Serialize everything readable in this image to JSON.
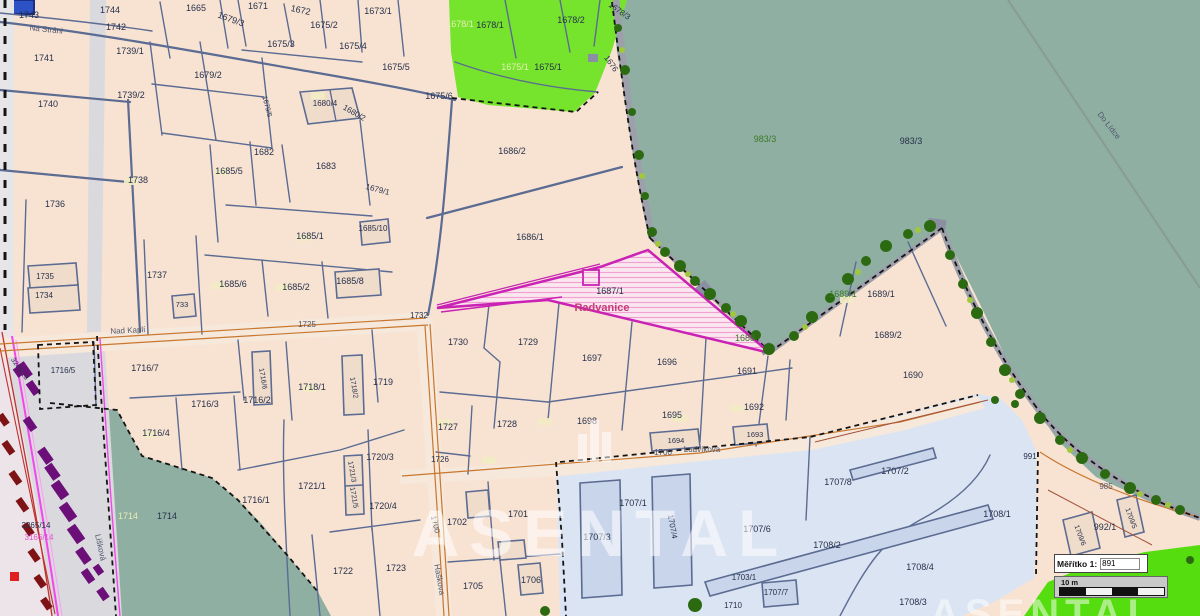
{
  "app": {
    "type": "cadastral-map-viewer"
  },
  "scale_widget": {
    "label": "Měřítko 1:",
    "value": "891",
    "bar_label": "10 m"
  },
  "watermark": {
    "text": "ASENTAL",
    "partial_text": "ASENTAL"
  },
  "colors": {
    "parcel_fill": "#f8e3d3",
    "forest_teal": "#8fafa2",
    "green_parcel": "#76e42d",
    "lawn": "#56dd10",
    "industrial_blue": "#dbe4f2",
    "water_blue": "#2d52c6",
    "boundary": "#5b6b92",
    "highlight_magenta": "#c922b4",
    "road_orange": "#c8772f",
    "area_name_red": "#c63a7a",
    "tree_green": "#2c6a12",
    "building_purple": "#6d0f78"
  },
  "map": {
    "area_label": "Radvanice",
    "highlighted_parcel_number": "1687/1",
    "streets": [
      "Na Stráni",
      "Nad Kaplí",
      "Ludvíkova",
      "Haškova",
      "Lišková",
      "Do Lídce"
    ],
    "road_numbers": [
      "1725",
      "1700",
      "1676",
      "985"
    ],
    "labels": [
      {
        "t": "1743",
        "x": 29,
        "y": 18
      },
      {
        "t": "1744",
        "x": 110,
        "y": 13
      },
      {
        "t": "1742",
        "x": 116,
        "y": 30
      },
      {
        "t": "1665",
        "x": 196,
        "y": 11
      },
      {
        "t": "1671",
        "x": 258,
        "y": 9
      },
      {
        "t": "1672",
        "x": 300,
        "y": 13,
        "r": 12
      },
      {
        "t": "1673/1",
        "x": 378,
        "y": 14
      },
      {
        "t": "1675/2",
        "x": 324,
        "y": 28
      },
      {
        "t": "1679/3",
        "x": 230,
        "y": 22,
        "r": 20
      },
      {
        "t": "1675/3",
        "x": 281,
        "y": 47
      },
      {
        "t": "1675/4",
        "x": 353,
        "y": 49
      },
      {
        "t": "1675/5",
        "x": 396,
        "y": 70
      },
      {
        "t": "1675/6",
        "x": 439,
        "y": 99
      },
      {
        "t": "1679/2",
        "x": 208,
        "y": 78
      },
      {
        "t": "1739/1",
        "x": 130,
        "y": 54
      },
      {
        "t": "1741",
        "x": 44,
        "y": 61
      },
      {
        "t": "1739/2",
        "x": 131,
        "y": 98
      },
      {
        "t": "1740",
        "x": 48,
        "y": 107
      },
      {
        "t": "1679/6",
        "x": 265,
        "y": 107,
        "r": 75,
        "s": 7
      },
      {
        "t": "1680/4",
        "x": 325,
        "y": 106,
        "s": 8
      },
      {
        "t": "1680/2",
        "x": 353,
        "y": 115,
        "r": 30,
        "s": 8
      },
      {
        "t": "1682",
        "x": 264,
        "y": 155
      },
      {
        "t": "1683",
        "x": 326,
        "y": 169
      },
      {
        "t": "1685/5",
        "x": 229,
        "y": 174
      },
      {
        "t": "1738",
        "x": 138,
        "y": 183
      },
      {
        "t": "1679/1",
        "x": 377,
        "y": 192,
        "r": 15,
        "s": 8
      },
      {
        "t": "1736",
        "x": 55,
        "y": 207
      },
      {
        "t": "1685/10",
        "x": 373,
        "y": 231,
        "s": 8
      },
      {
        "t": "1685/1",
        "x": 310,
        "y": 239
      },
      {
        "t": "1737",
        "x": 157,
        "y": 278
      },
      {
        "t": "1735",
        "x": 45,
        "y": 279,
        "s": 8
      },
      {
        "t": "1685/6",
        "x": 233,
        "y": 287
      },
      {
        "t": "1685/2",
        "x": 296,
        "y": 290
      },
      {
        "t": "1685/8",
        "x": 350,
        "y": 284
      },
      {
        "t": "1734",
        "x": 44,
        "y": 298,
        "s": 8
      },
      {
        "t": "733",
        "x": 182,
        "y": 307,
        "s": 7.5
      },
      {
        "t": "1686/2",
        "x": 512,
        "y": 154
      },
      {
        "t": "1686/1",
        "x": 530,
        "y": 240
      },
      {
        "t": "1678/1",
        "x": 460,
        "y": 27,
        "c": "y"
      },
      {
        "t": "1678/1",
        "x": 490,
        "y": 28
      },
      {
        "t": "1678/2",
        "x": 571,
        "y": 23
      },
      {
        "t": "1678/3",
        "x": 618,
        "y": 13,
        "r": 35,
        "s": 8
      },
      {
        "t": "1675/1",
        "x": 515,
        "y": 70,
        "c": "y"
      },
      {
        "t": "1675/1",
        "x": 548,
        "y": 70
      },
      {
        "t": "1676",
        "x": 609,
        "y": 65,
        "r": 55,
        "s": 8
      },
      {
        "t": "983/3",
        "x": 765,
        "y": 142,
        "c": "g"
      },
      {
        "t": "983/3",
        "x": 911,
        "y": 144
      },
      {
        "t": "Do Lídce",
        "x": 1107,
        "y": 127,
        "r": 52,
        "c": "s"
      },
      {
        "t": "1687/1",
        "x": 610,
        "y": 294
      },
      {
        "t": "Radvanice",
        "x": 602,
        "y": 311,
        "c": "m"
      },
      {
        "t": "1688",
        "x": 745,
        "y": 341,
        "c": "g"
      },
      {
        "t": "1689/1",
        "x": 843,
        "y": 297,
        "c": "g"
      },
      {
        "t": "1689/1",
        "x": 881,
        "y": 297
      },
      {
        "t": "1689/2",
        "x": 888,
        "y": 338
      },
      {
        "t": "1690",
        "x": 913,
        "y": 378
      },
      {
        "t": "1691",
        "x": 747,
        "y": 374
      },
      {
        "t": "1732",
        "x": 419,
        "y": 318,
        "s": 8
      },
      {
        "t": "1730",
        "x": 458,
        "y": 345
      },
      {
        "t": "1729",
        "x": 528,
        "y": 345
      },
      {
        "t": "1697",
        "x": 592,
        "y": 361
      },
      {
        "t": "1696",
        "x": 667,
        "y": 365
      },
      {
        "t": "Nad Kaplí",
        "x": 128,
        "y": 333,
        "r": -3,
        "c": "s"
      },
      {
        "t": "1725",
        "x": 307,
        "y": 327,
        "c": "s"
      },
      {
        "t": "1716/5",
        "x": 63,
        "y": 373,
        "s": 8
      },
      {
        "t": "1716/7",
        "x": 145,
        "y": 371
      },
      {
        "t": "1716/6",
        "x": 261,
        "y": 379,
        "r": 80,
        "s": 7
      },
      {
        "t": "1718/1",
        "x": 312,
        "y": 390
      },
      {
        "t": "1718/2",
        "x": 352,
        "y": 388,
        "r": 80,
        "s": 7
      },
      {
        "t": "1719",
        "x": 383,
        "y": 385
      },
      {
        "t": "1716/3",
        "x": 205,
        "y": 407
      },
      {
        "t": "1716/2",
        "x": 257,
        "y": 403
      },
      {
        "t": "1716/4",
        "x": 156,
        "y": 436
      },
      {
        "t": "1716/1",
        "x": 256,
        "y": 503
      },
      {
        "t": "1721/1",
        "x": 312,
        "y": 489
      },
      {
        "t": "1720/3",
        "x": 380,
        "y": 460
      },
      {
        "t": "1721/3",
        "x": 350,
        "y": 472,
        "r": 80,
        "s": 7
      },
      {
        "t": "1721/5",
        "x": 352,
        "y": 498,
        "r": 80,
        "s": 7
      },
      {
        "t": "1720/4",
        "x": 383,
        "y": 509
      },
      {
        "t": "1714",
        "x": 128,
        "y": 519,
        "c": "y"
      },
      {
        "t": "1714",
        "x": 167,
        "y": 519
      },
      {
        "t": "3265/14",
        "x": 36,
        "y": 528,
        "s": 8
      },
      {
        "t": "3166/14",
        "x": 39,
        "y": 540,
        "c": "mg",
        "s": 8
      },
      {
        "t": "3265/13",
        "x": 18,
        "y": 370,
        "r": 55,
        "s": 7
      },
      {
        "t": "Lišková",
        "x": 98,
        "y": 548,
        "r": 78,
        "c": "s"
      },
      {
        "t": "1722",
        "x": 343,
        "y": 574
      },
      {
        "t": "1723",
        "x": 396,
        "y": 571
      },
      {
        "t": "1727",
        "x": 448,
        "y": 430
      },
      {
        "t": "1728",
        "x": 507,
        "y": 427
      },
      {
        "t": "1726",
        "x": 440,
        "y": 462,
        "s": 8
      },
      {
        "t": "1698",
        "x": 587,
        "y": 424
      },
      {
        "t": "1695",
        "x": 672,
        "y": 418
      },
      {
        "t": "1692",
        "x": 754,
        "y": 410
      },
      {
        "t": "1694",
        "x": 676,
        "y": 443,
        "s": 7.5
      },
      {
        "t": "1693",
        "x": 755,
        "y": 437,
        "s": 7.5
      },
      {
        "t": "1700",
        "x": 663,
        "y": 455,
        "c": "s"
      },
      {
        "t": "Ludvíkova",
        "x": 702,
        "y": 452,
        "c": "s"
      },
      {
        "t": "1700",
        "x": 433,
        "y": 525,
        "r": 75,
        "c": "s"
      },
      {
        "t": "Haškova",
        "x": 437,
        "y": 580,
        "r": 80,
        "c": "s"
      },
      {
        "t": "1701",
        "x": 518,
        "y": 517
      },
      {
        "t": "1702",
        "x": 457,
        "y": 525
      },
      {
        "t": "1705",
        "x": 473,
        "y": 589
      },
      {
        "t": "1706",
        "x": 531,
        "y": 583
      },
      {
        "t": "1707/1",
        "x": 633,
        "y": 506
      },
      {
        "t": "1707/3",
        "x": 597,
        "y": 540
      },
      {
        "t": "1707/4",
        "x": 670,
        "y": 527,
        "r": 80,
        "s": 8
      },
      {
        "t": "1707/6",
        "x": 757,
        "y": 532
      },
      {
        "t": "1707/7",
        "x": 776,
        "y": 595,
        "s": 8
      },
      {
        "t": "1703/1",
        "x": 744,
        "y": 580,
        "s": 8
      },
      {
        "t": "1710",
        "x": 733,
        "y": 608,
        "s": 8
      },
      {
        "t": "1707/2",
        "x": 895,
        "y": 474
      },
      {
        "t": "1707/8",
        "x": 838,
        "y": 485
      },
      {
        "t": "1708/1",
        "x": 997,
        "y": 517
      },
      {
        "t": "1708/2",
        "x": 827,
        "y": 548
      },
      {
        "t": "1708/4",
        "x": 920,
        "y": 570
      },
      {
        "t": "1708/3",
        "x": 913,
        "y": 605
      },
      {
        "t": "991",
        "x": 1030,
        "y": 459,
        "s": 8
      },
      {
        "t": "992/1",
        "x": 1105,
        "y": 530
      },
      {
        "t": "1709/6",
        "x": 1078,
        "y": 536,
        "r": 70,
        "s": 7
      },
      {
        "t": "1709/5",
        "x": 1129,
        "y": 519,
        "r": 70,
        "s": 7
      },
      {
        "t": "985",
        "x": 1106,
        "y": 489,
        "c": "s"
      },
      {
        "t": "Na Stráni",
        "x": 46,
        "y": 32,
        "r": 6,
        "c": "s"
      }
    ]
  }
}
